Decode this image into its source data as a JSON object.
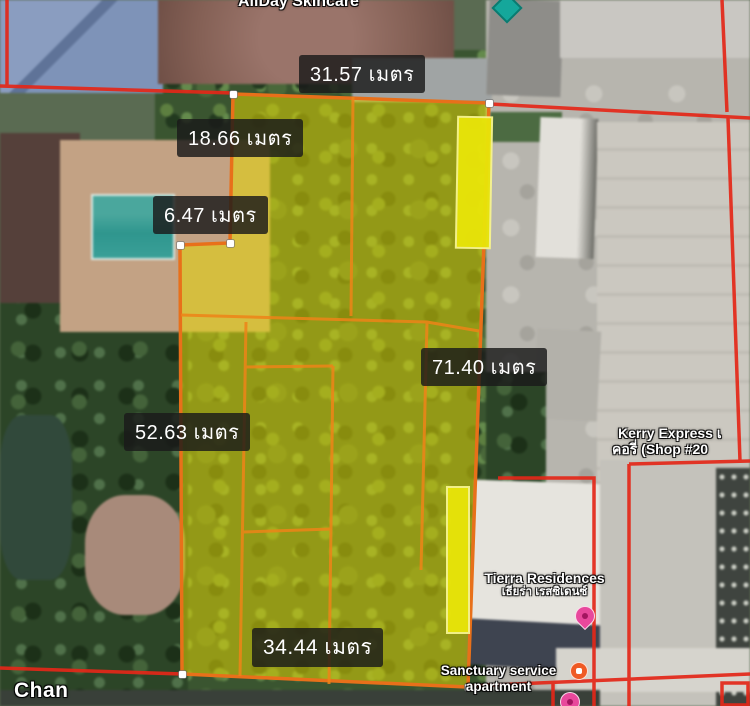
{
  "map": {
    "street_label": "Chan",
    "unit_word": "เมตร"
  },
  "measurements": {
    "top_width": {
      "text": "31.57 เมตร"
    },
    "left_upper": {
      "text": "18.66 เมตร"
    },
    "notch": {
      "text": "6.47 เมตร"
    },
    "right_length": {
      "text": "71.40 เมตร"
    },
    "left_length": {
      "text": "52.63 เมตร"
    },
    "bottom_width": {
      "text": "34.44 เมตร"
    }
  },
  "places": {
    "allday": {
      "name": "AllDay Skincare"
    },
    "kerry": {
      "line1": "Kerry Express เ",
      "line2": "คอรี่ (Shop #20"
    },
    "tierra": {
      "name": "Tierra Residences",
      "subtitle": "เธียร่า เรสซิเดนซ์"
    },
    "sanctuary": {
      "line1": "Sanctuary service",
      "line2": "apartment"
    }
  },
  "colors": {
    "plot_fill": "#e7d800",
    "plot_stroke": "#e8701a",
    "subdivision_line": "#ee8418",
    "parcel_line": "#e42718",
    "highlight_strip": "#e9e509",
    "measure_label_bg": "#1a1a1a",
    "measure_label_text": "#ffffff",
    "marker_pink": "#e8489c",
    "marker_teal": "#15a79b",
    "marker_orange": "#ef5a24"
  }
}
